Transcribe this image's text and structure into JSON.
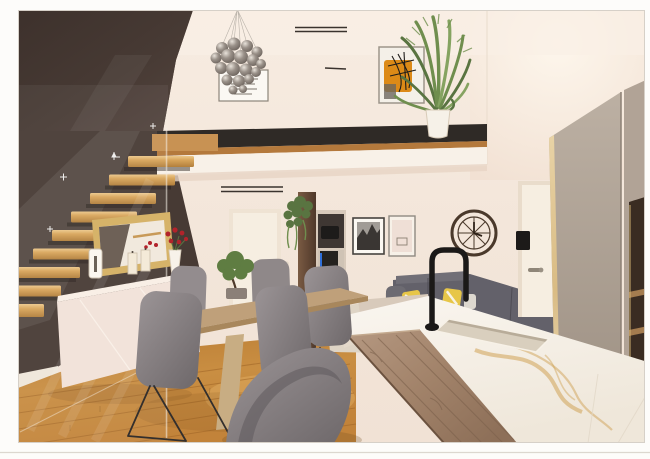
{
  "scene": {
    "type": "architectural interior rendering (scanned photo print)",
    "view": "open-plan loft living space with mezzanine",
    "objects": [
      "dark accent staircase wall",
      "floating oak stair treads",
      "glass balustrade",
      "mezzanine balcony with wood trim",
      "bubble glass-ball chandelier",
      "framed typography poster",
      "framed orange abstract artwork",
      "potted palm plant",
      "white interior door",
      "hanging ivy plant on wood pillar",
      "tv niche shelf unit",
      "gold framed mirror",
      "cream sideboard with candles, sculpture and rose vase",
      "wooden dining table with bonsai centerpiece",
      "grey upholstered sled-leg chairs",
      "grey corner sofa with yellow striped pillows",
      "black and white city photo frame",
      "pale art print frame",
      "roman skeleton wall clock",
      "black arch kitchen faucet",
      "marble kitchen island with undermount sink",
      "wooden breakfast-bar plank",
      "tall greige wardrobe panels",
      "dark brown open shelving",
      "cream door with lever handle and intercom panel",
      "oak plank flooring",
      "beige area rug",
      "linear ceiling vents"
    ]
  },
  "colors": {
    "paper_white": "#fdfcfa",
    "scan_line": "#dcd7cf",
    "wall_cream": "#f3e7db",
    "wall_mezz": "#f6ece2",
    "accent_wall": "#473a34",
    "stair_wood": "#d9a65c",
    "stair_cap": "#c89253",
    "mezz_band": "#2f2a26",
    "trim_wood": "#b4793c",
    "fascia": "#f8f1e8",
    "floor_wood": "#c4873d",
    "floor_seam": "#9e6426",
    "rug": "#ded4c5",
    "table_wood": "#bfa07a",
    "chair_fabric": "#8f8889",
    "chair_dark": "#5f5a5c",
    "leg_metal": "#332f2d",
    "sideboard": "#f2e3da",
    "mirror_gold": "#d6b369",
    "sofa": "#63616a",
    "sofa_arm": "#6d6b72",
    "pillow_yellow": "#e7c648",
    "marble": "#f8f3ec",
    "marble_vein": "#cfa255",
    "sink": "#d9cfbe",
    "board_wood": "#a2836a",
    "board_grain": "#7c614c",
    "faucet_black": "#1b1918",
    "greige_panel": "#b3a698",
    "gold_edge": "#dcc08a",
    "shelf_brown": "#3a2c22",
    "shelf_line": "#a47c4f",
    "door_cream": "#f6eee1",
    "pillar_wood": "#6b4f3a",
    "tv_blue": "#2f6fd8",
    "plant_green": "#6f8e4e",
    "plant_green_dark": "#597441",
    "plant_green_light": "#85a361",
    "art_orange": "#dc8a17",
    "clock_bronze": "#4a392b",
    "rose_red": "#b2232b",
    "sphere_grey": "#8d847c"
  }
}
